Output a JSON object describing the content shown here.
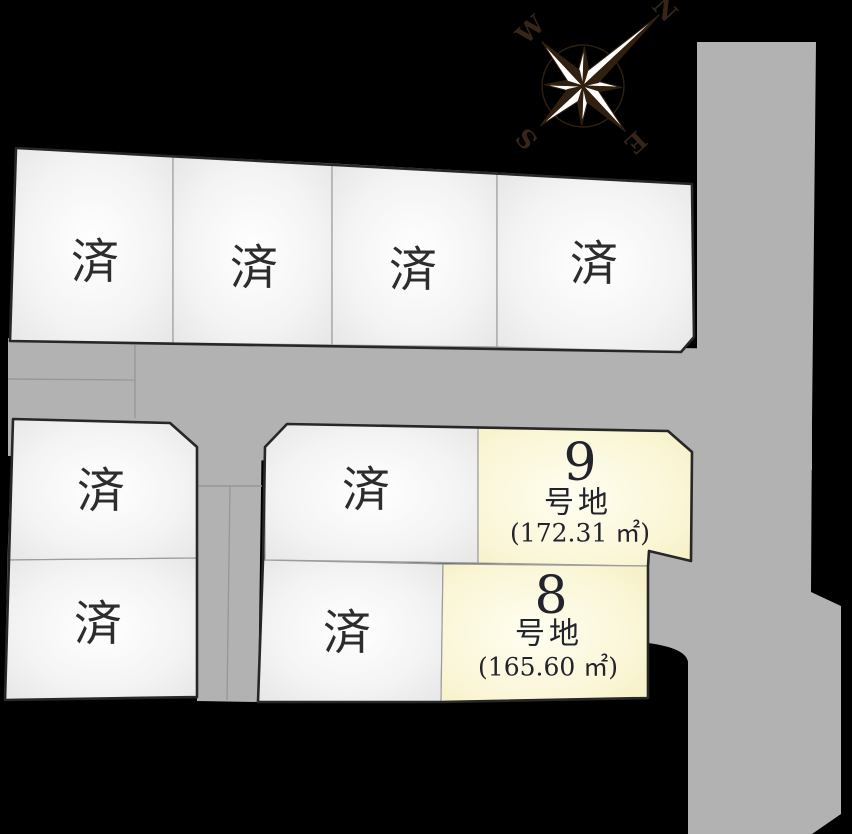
{
  "compass": {
    "n": "N",
    "e": "E",
    "s": "S",
    "w": "W"
  },
  "labels": {
    "sold": "済"
  },
  "plots": {
    "sold_count": 8,
    "available": [
      {
        "number": "9",
        "suffix": "号地",
        "area": "(172.31 ㎡)"
      },
      {
        "number": "8",
        "suffix": "号地",
        "area": "(165.60 ㎡)"
      }
    ]
  },
  "colors": {
    "background": "#000000",
    "road": "#b2b2b2",
    "lane_line": "#989898",
    "plot_fill": "#f3f3f3",
    "plot_highlight": "#faf6d3",
    "outline": "#272727",
    "divider": "#9c9c9c",
    "text": "#23232b",
    "compass_dark": "#31200f"
  }
}
